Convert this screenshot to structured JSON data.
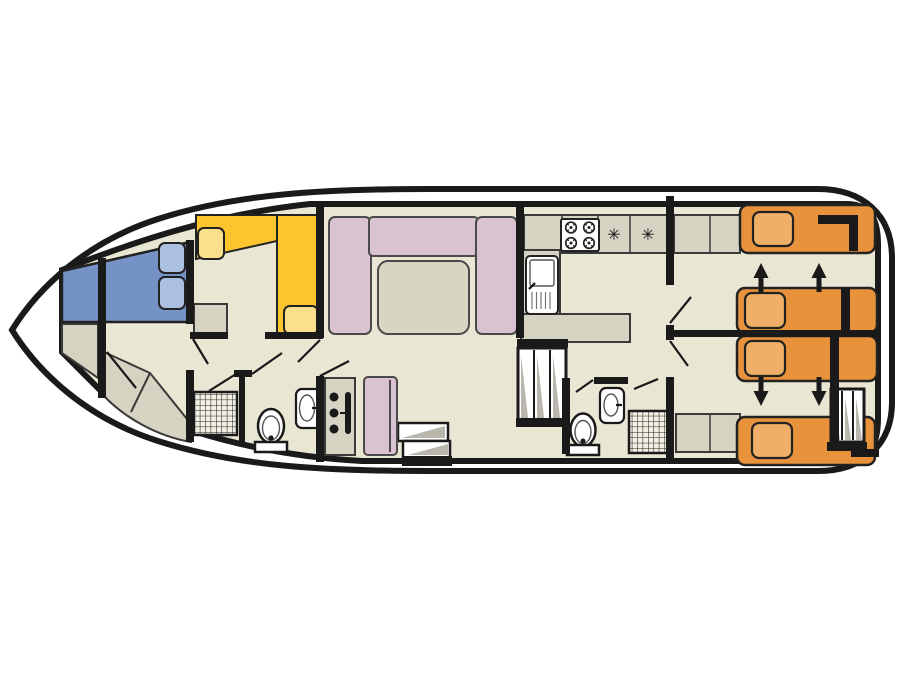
{
  "symbols": {
    "galley_appliance_1": "✳",
    "galley_appliance_2": "✳"
  },
  "colors": {
    "background": "#ffffff",
    "line": "#1a1a1a",
    "floor": "#e9e6d3",
    "cabinet": "#d6d3c2",
    "bed_blue": "#7592c7",
    "pillow_blue": "#abbfe0",
    "sofa_yellow": "#fdc42e",
    "cushion_yellow": "#fcdf8a",
    "sofa_pink": "#d9c3d1",
    "table": "#d8d5c3",
    "bed_orange": "#e8923c",
    "pillow_orange": "#efaf67",
    "hatch": "#b9b7ad",
    "fixture": "#ffffff"
  }
}
